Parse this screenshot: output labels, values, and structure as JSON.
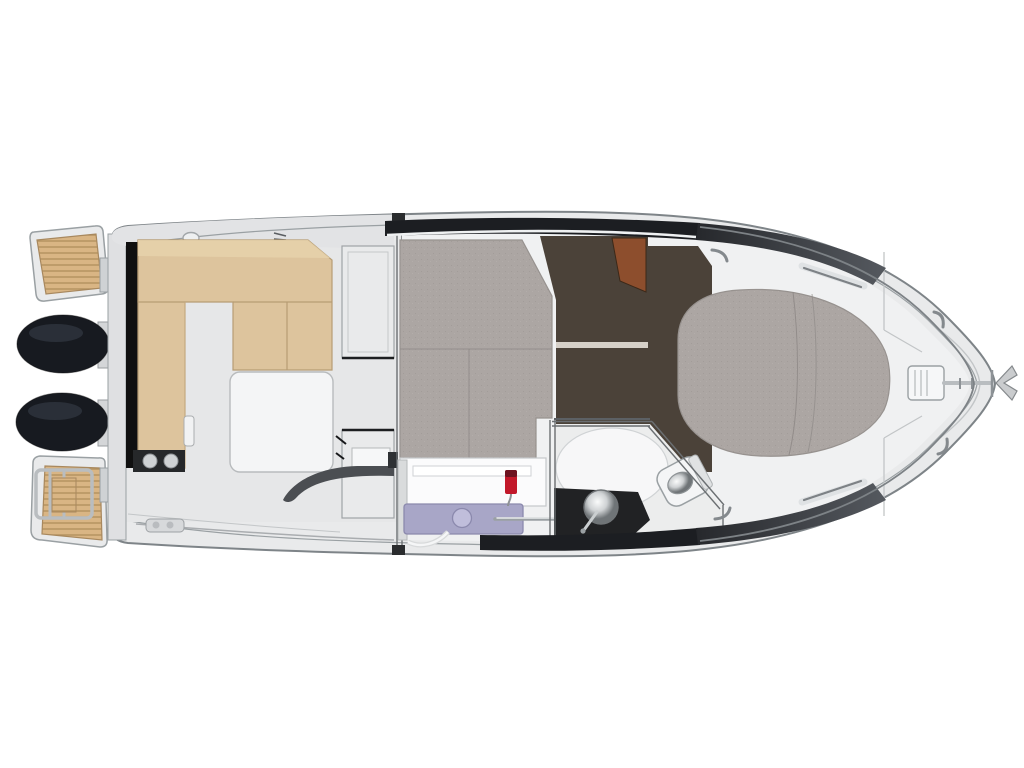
{
  "scene": {
    "description": "Top-down deck and cabin layout plan of a motor boat, bow pointing right, twin outboard engines at stern left",
    "background": "#ffffff"
  },
  "colors": {
    "background": "#ffffff",
    "hull_fill": "#e9eaeb",
    "hull_stroke": "#7e8488",
    "gunwale_band": "#e2e3e5",
    "deck_white": "#f0f1f2",
    "cockpit_floor": "#e6e7e8",
    "teak": "#d9b584",
    "teak_stripe": "#b3925f",
    "engine_black": "#171a20",
    "engine_highlight": "#2e343d",
    "seat_tan": "#ddc49d",
    "seat_border": "#b79d74",
    "seat_top_light": "#e7d3ac",
    "black_strip": "#101010",
    "berth_gray": "#aca6a3",
    "berth_seam": "#8f8a87",
    "floor_brown": "#4b4239",
    "wood_door": "#8d4e2d",
    "galley_counter": "#a8a6c7",
    "galley_counter_line": "#8b89ad",
    "sink_lavender": "#c0bedb",
    "faucet_red": "#c2182a",
    "faucet_dark": "#6d1320",
    "bath_dark": "#212224",
    "shower_white": "#f7f7f8",
    "bath_floor": "#eceded",
    "window_band": "#1c1e22",
    "bow_band": "#43474d",
    "chrome": "#dfe2e4",
    "metal_mid": "#9b9fa2",
    "module_gray": "#e9eaeb",
    "table_white": "#f4f5f6",
    "console_dark": "#4b4e52",
    "walkway": "#d7d9db"
  },
  "parts": {
    "swim-platform-port": "teak swim platform top-left",
    "swim-platform-starboard": "teak swim platform with boarding ladder bottom-left",
    "outboard-engines": "two black engine cowls on transom",
    "cockpit-seating": "L-shaped tan bench around cockpit",
    "cockpit-table": "white table/sunpad",
    "mid-cabin-berth": "gray upholstered berth amidships",
    "galley": "lavender counter with round sink and red faucet",
    "head-compartment": "bathroom with round basin and toilet",
    "bow-island-berth": "oval gray berth in forward cabin",
    "windlass-and-anchor": "anchor fitting at bow tip"
  }
}
